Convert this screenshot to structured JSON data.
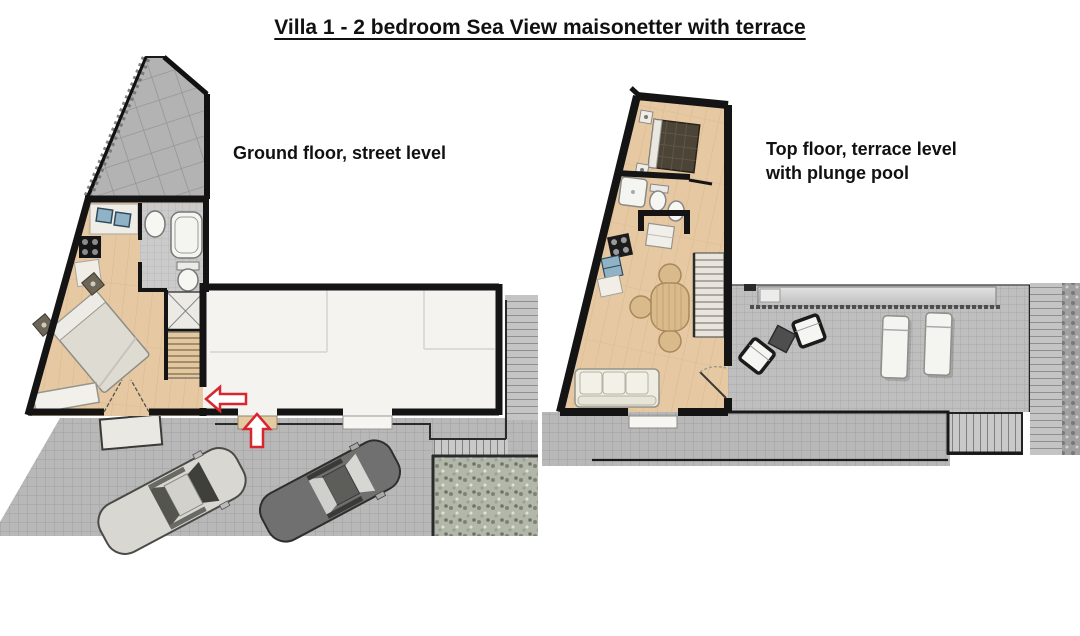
{
  "title": "Villa 1 - 2 bedroom Sea View maisonetter with terrace",
  "plans": {
    "ground": {
      "label": "Ground floor, street level"
    },
    "top": {
      "label_line1": "Top floor, terrace level",
      "label_line2": "with plunge pool"
    }
  },
  "colors": {
    "accent_red": "#d8252e",
    "wall_black": "#141414",
    "wood_floor": "#e6c9a2",
    "paving_gray": "#b8b8b8",
    "terrace_gray": "#bfbfbf",
    "roof_gray": "#b3b3b3",
    "white_room": "#f4f3f0",
    "garden_green_gray": "#b3b7aa",
    "pool_gray": "#d9d9d9",
    "bed_dark_brown": "#4c4537",
    "car_light": "#d8d7d2",
    "car_dark": "#707070"
  }
}
